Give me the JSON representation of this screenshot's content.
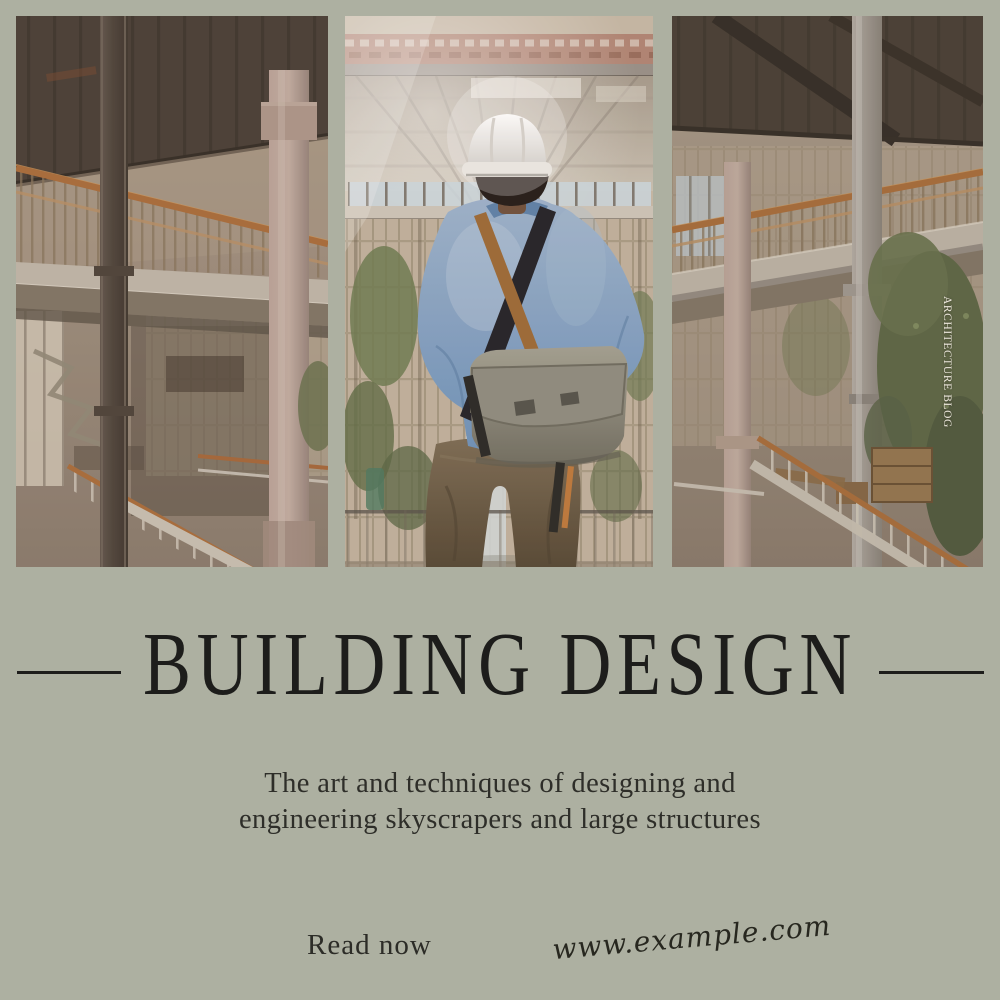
{
  "masthead": {
    "vertical_label": "ARCHITECTURE BLOG"
  },
  "title": {
    "text": "BUILDING DESIGN"
  },
  "subtitle": {
    "line1": "The art and techniques of designing and",
    "line2": "engineering skyscrapers and large structures"
  },
  "footer": {
    "read_now": "Read now",
    "website": "www.example.com"
  },
  "photo": {
    "description": "Engineer in white hard hat and blue shirt with gray messenger bag, seen from behind, overlooking an unfinished building atrium; triptych of three panels",
    "panels": 3
  },
  "palette": {
    "background": "#adb0a1",
    "title_color": "#1d1d1b",
    "subtitle_color": "#2e2e29",
    "badge_text_color": "#ece7dc",
    "rail_orange": "#b2713c",
    "shirt_blue": "#7f9ec0",
    "helmet_white": "#f2f1ee",
    "bag_gray": "#94927f",
    "pants_brown": "#6e5f4a"
  }
}
